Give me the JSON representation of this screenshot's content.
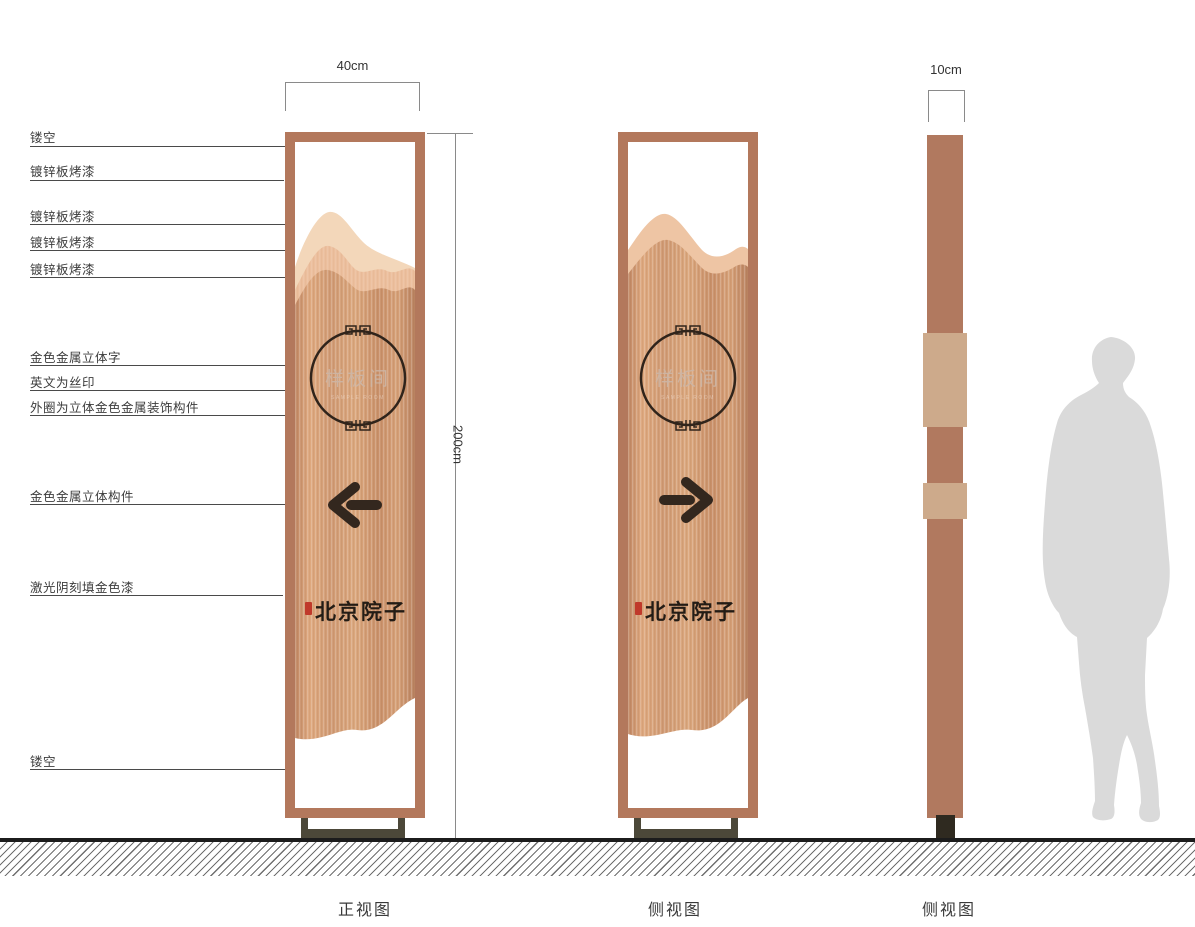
{
  "callouts": [
    "镂空",
    "镀锌板烤漆",
    "镀锌板烤漆",
    "镀锌板烤漆",
    "镀锌板烤漆",
    "金色金属立体字",
    "英文为丝印",
    "外圈为立体金色金属装饰构件",
    "金色金属立体构件",
    "激光阴刻填金色漆",
    "镂空"
  ],
  "dimensions": {
    "front_width": "40cm",
    "height": "200cm",
    "side_depth": "10cm"
  },
  "views": [
    {
      "caption": "正视图"
    },
    {
      "caption": "侧视图"
    },
    {
      "caption": "侧视图"
    }
  ],
  "sign": {
    "room_name": "样板间",
    "room_name_en": "SAMPLE ROOM",
    "brand": "北京院子"
  },
  "colors": {
    "frame": "#b3785c",
    "copper": "#d29a74",
    "mountain_light": "#f3d7ba",
    "mountain_mid": "#ecbf9d",
    "dark_accent": "#33271e",
    "seal_red": "#c0392b",
    "base_olive": "#4c4839",
    "silhouette_gray": "#dadada"
  }
}
